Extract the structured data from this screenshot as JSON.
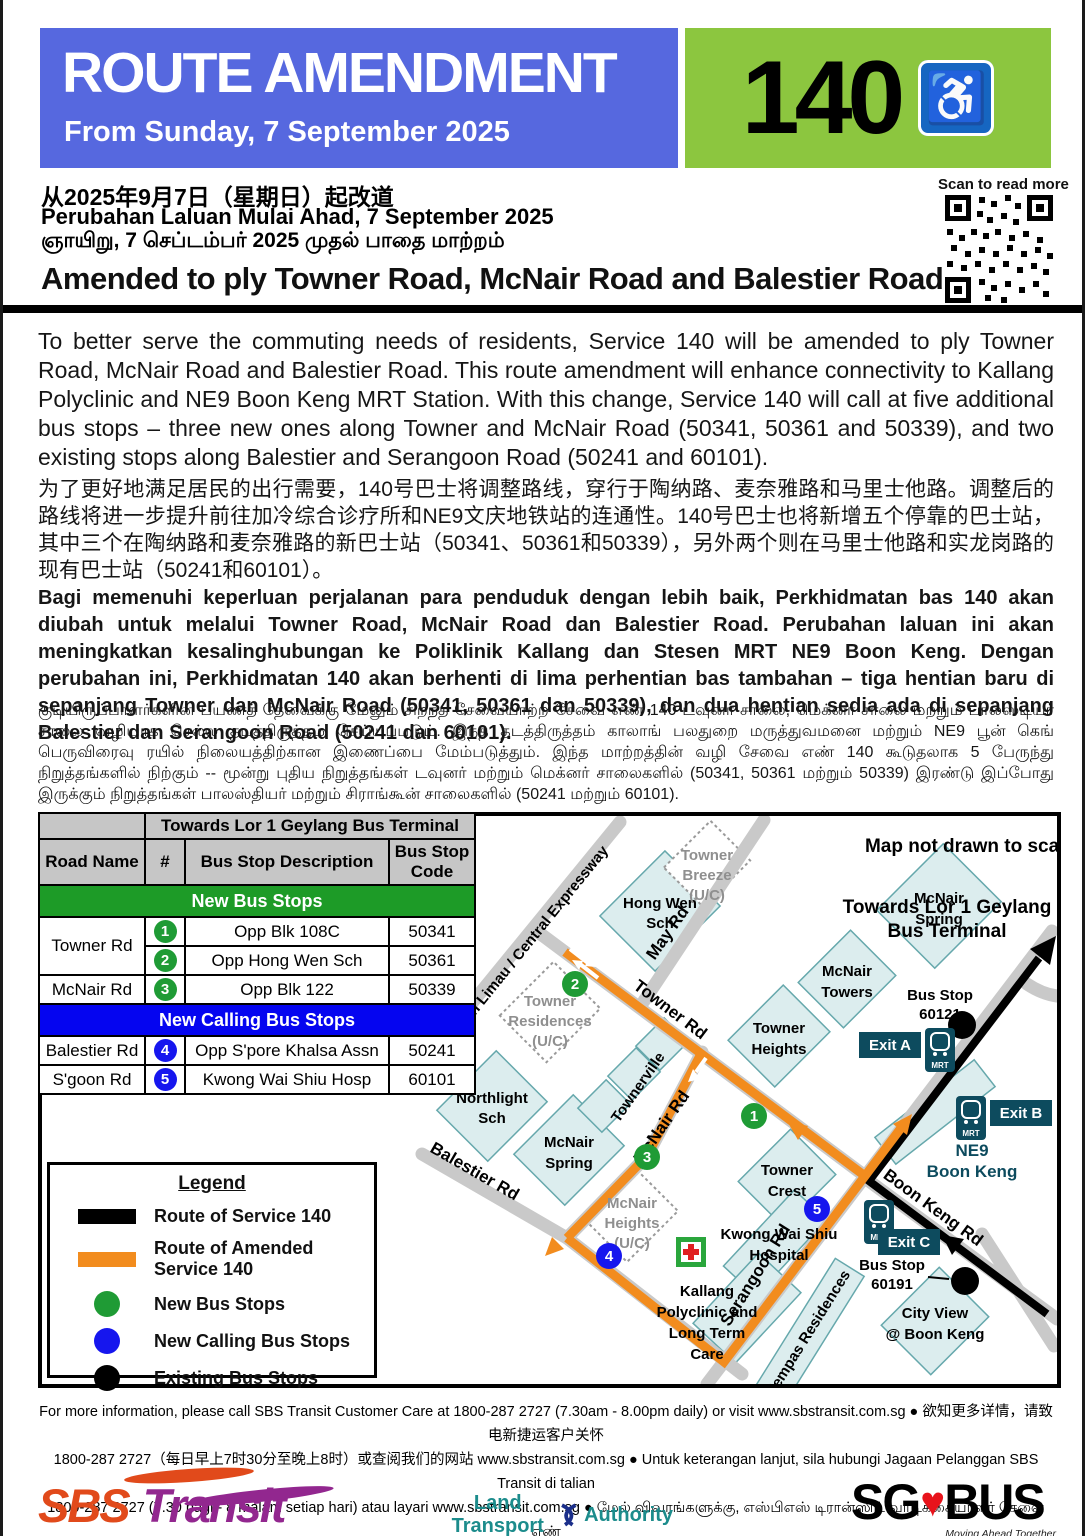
{
  "colors": {
    "header_blue": "#5668DF",
    "service_green": "#8CC63F",
    "wheelchair_blue": "#1666C1",
    "band_green": "#1D9B27",
    "band_blue": "#0505F0",
    "stop_green": "#1F9B35",
    "stop_blue": "#1616EE",
    "route_orange": "#F28C1E",
    "route_black": "#000000",
    "mrt_teal": "#0D4B5E",
    "sbs_red": "#E14A1B",
    "sbs_purple": "#92278F",
    "lta_teal": "#1C8C8C",
    "sgbus_red": "#E8131B"
  },
  "header": {
    "title": "ROUTE AMENDMENT",
    "date_line": "From Sunday, 7 September 2025",
    "service_number": "140",
    "wheelchair_icon": "♿",
    "scan_label": "Scan to read more"
  },
  "subheader": {
    "zh": "从2025年9月7日（星期日）起改道",
    "ms": "Perubahan Laluan Mulai Ahad, 7 September 2025",
    "ta": "ஞாயிறு, 7 செப்டம்பர் 2025 முதல் பாதை மாற்றம்",
    "headline": "Amended to ply Towner Road, McNair Road and Balestier Road"
  },
  "paragraphs": {
    "en": "To better serve the commuting needs of residents, Service 140 will be amended to ply Towner Road, McNair Road and Balestier Road. This route amendment will enhance connectivity to Kallang Polyclinic and NE9 Boon Keng MRT Station. With this change, Service 140 will call at five additional bus stops – three new ones along Towner and McNair Road (50341, 50361 and 50339), and two existing stops along Balestier and Serangoon Road (50241 and 60101).",
    "zh": "为了更好地满足居民的出行需要，140号巴士将调整路线，穿行于陶纳路、麦奈雅路和马里士他路。调整后的路线将进一步提升前往加冷综合诊疗所和NE9文庆地铁站的连通性。140号巴士也将新增五个停靠的巴士站，其中三个在陶纳路和麦奈雅路的新巴士站（50341、50361和50339），另外两个则在马里士他路和实龙岗路的现有巴士站（50241和60101）。",
    "ms": "Bagi memenuhi keperluan perjalanan para penduduk dengan lebih baik, Perkhidmatan bas 140 akan diubah untuk melalui Towner Road, McNair Road dan Balestier Road. Perubahan laluan ini akan meningkatkan kesalinghubungan ke Poliklinik Kallang dan Stesen MRT NE9 Boon Keng. Dengan perubahan ini, Perkhidmatan 140 akan berhenti di lima perhentian bas tambahan – tiga hentian baru di sepanjang Towner dan McNair Road (50341, 50361 dan 50339), dan dua hentian sedia ada di sepanjang Balestier dan Serangoon Road (50241 dan 60101).",
    "ta": "குடியிருப்பாளர்களின் பயணத் தேவைக்கு மேலும் சிறந்த சேவையாற்ற சேவை எண் 140  டவுனர் சாலை, மெக்னர் சாலை மற்றும் பாலஸ்டியர் சாலை வழியாக செல்ல தடத்திருத்தம் செய்யப்படும். இந்த தடத்திருத்தம் காலாங் பலதுறை மருத்துவமனை மற்றும் NE9 பூன் கெங் பெருவிரைவு ரயில் நிலையத்திற்கான இணைப்பை மேம்படுத்தும். இந்த மாற்றத்தின் வழி சேவை எண் 140 கூடுதலாக 5 பேருந்து நிறுத்தங்களில் நிற்கும் -- மூன்று புதிய நிறுத்தங்கள் டவுனர் மற்றும் மெக்னர் சாலைகளில் (50341, 50361 மற்றும் 50339) இரண்டு இப்போது இருக்கும் நிறுத்தங்கள் பாலஸ்தியர் மற்றும் சிராங்கூன் சாலைகளில் (50241 மற்றும் 60101)."
  },
  "table": {
    "direction_header": "Towards Lor 1 Geylang Bus Terminal",
    "columns": [
      "Road Name",
      "#",
      "Bus Stop Description",
      "Bus Stop Code"
    ],
    "section_new": "New Bus Stops",
    "section_calling": "New Calling Bus Stops",
    "rows": [
      {
        "road": "Towner Rd",
        "num": "1",
        "desc": "Opp Blk 108C",
        "code": "50341"
      },
      {
        "road": "Towner Rd",
        "num": "2",
        "desc": "Opp Hong Wen Sch",
        "code": "50361"
      },
      {
        "road": "McNair Rd",
        "num": "3",
        "desc": "Opp Blk 122",
        "code": "50339"
      },
      {
        "road": "Balestier Rd",
        "num": "4",
        "desc": "Opp S'pore Khalsa Assn",
        "code": "50241"
      },
      {
        "road": "S'goon Rd",
        "num": "5",
        "desc": "Kwong Wai Shiu Hosp",
        "code": "60101"
      }
    ]
  },
  "legend": {
    "title": "Legend",
    "items": [
      {
        "label": "Route of Service 140"
      },
      {
        "label": "Route of Amended Service 140"
      },
      {
        "label": "New Bus Stops"
      },
      {
        "label": "New Calling Bus Stops"
      },
      {
        "label": "Existing Bus Stops"
      }
    ]
  },
  "map": {
    "labels": {
      "not_to_scale": "Map not drawn to scale",
      "towards": [
        "Towards Lor 1 Geylang",
        "Bus Terminal"
      ],
      "expressway": "Jln Kebun Limau / Central Expressway",
      "may_rd": "May Rd",
      "towner_rd": "Towner Rd",
      "mcnair_rd": "McNair Rd",
      "balestier_rd": "Balestier Rd",
      "serangoon_rd": "Serangoon  Rd",
      "boon_keng_rd": "Boon Keng Rd",
      "townerville": "Townerville",
      "kempas": "Kempas Residences",
      "hong_wen": [
        "Hong Wen",
        "Sch"
      ],
      "towner_breeze": [
        "Towner",
        "Breeze",
        "(U/C)"
      ],
      "towner_residences": [
        "Towner",
        "Residences",
        "(U/C)"
      ],
      "northlight": [
        "Northlight",
        "Sch"
      ],
      "mcnair_spring": [
        "McNair",
        "Spring"
      ],
      "mcnair_towers": [
        "McNair",
        "Towers"
      ],
      "towner_heights": [
        "Towner",
        "Heights"
      ],
      "towner_crest": [
        "Towner",
        "Crest"
      ],
      "mcnair_heights": [
        "McNair",
        "Heights",
        "(U/C)"
      ],
      "kwong_wai": [
        "Kwong Wai Shiu",
        "Hospital"
      ],
      "kallang": [
        "Kallang",
        "Polyclinic and",
        "Long Term",
        "Care"
      ],
      "city_view": [
        "City View",
        "@ Boon Keng"
      ],
      "ne9": [
        "NE9",
        "Boon Keng"
      ],
      "exit_a": "Exit A",
      "exit_b": "Exit B",
      "exit_c": "Exit C",
      "mrt": "MRT",
      "stop_60121": [
        "Bus Stop",
        "60121"
      ],
      "stop_60191": [
        "Bus Stop",
        "60191"
      ]
    },
    "stops": [
      "1",
      "2",
      "3",
      "4",
      "5"
    ]
  },
  "footer": {
    "lines": [
      "For more information, please call SBS Transit Customer Care at 1800-287 2727 (7.30am - 8.00pm daily) or visit www.sbstransit.com.sg ● 欲知更多详情，请致电新捷运客户关怀",
      "1800-287 2727（每日早上7时30分至晚上8时）或查阅我们的网站 www.sbstransit.com.sg ● Untuk keterangan lanjut, sila hubungi Jagaan Pelanggan SBS Transit di talian",
      "1800-287 2727 (7.30 pagi - 8 malam setiap hari) atau layari www.sbstransit.com.sg ● மேல் விவரங்களுக்கு, எஸ்பிஎஸ் டிரான்ஸிட் வாடிக்கையாளர் சேவை எண்",
      "1800-287 2727 (தினமும் காலை 7.30 மணி – இரவு 8.00 மணி) அழைக்கவும் அல்லது www.sbstransit.com.sg என்ற இணையப் பக்கத்திற்குச் செல்லவும்"
    ]
  },
  "logos": {
    "sbs": {
      "part1": "SBS",
      "part2": "Transit"
    },
    "lta": {
      "part1": "Land Transport",
      "part2": "Authority",
      "tagline": "We Keep Your World",
      "moving": "Moving"
    },
    "sgbus": {
      "part1": "SG",
      "heart": "♥",
      "part2": "BUS",
      "tagline": "Moving Ahead Together"
    }
  }
}
